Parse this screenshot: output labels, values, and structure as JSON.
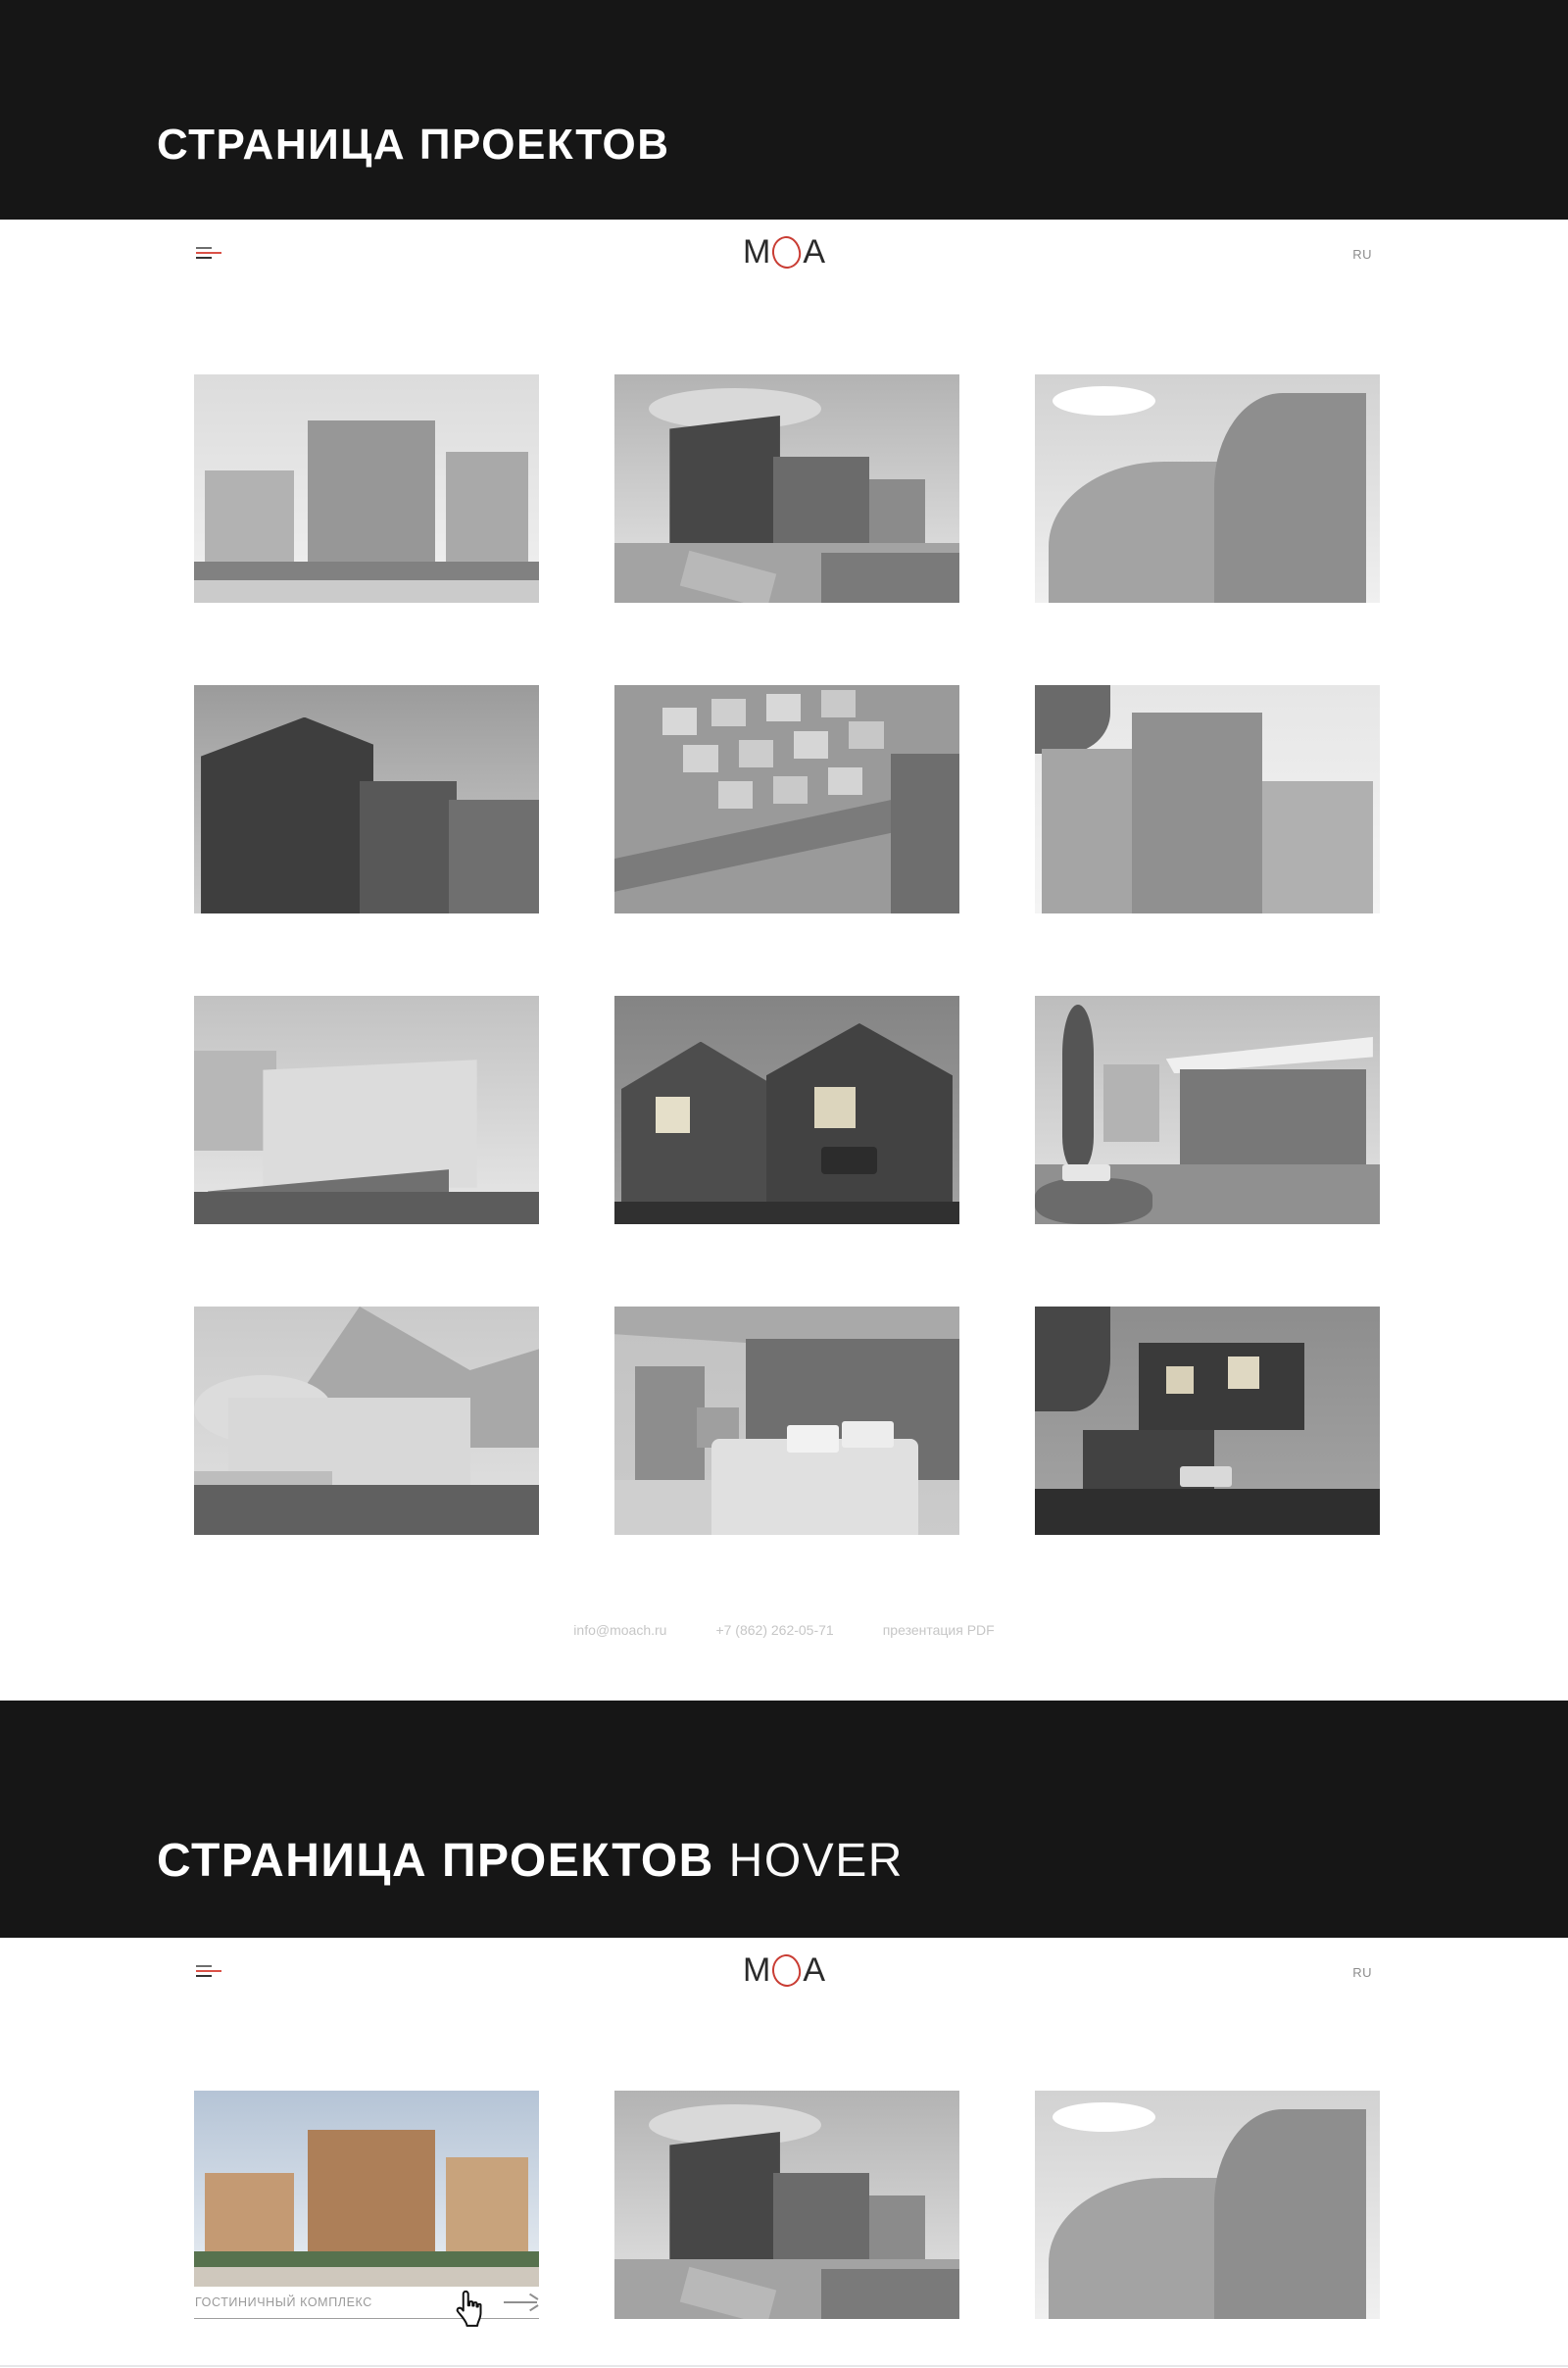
{
  "banners": {
    "projects_page_title": "СТРАНИЦА ПРОЕКТОВ",
    "hover_suffix": "HOVER"
  },
  "header": {
    "logo_text": "MOA",
    "logo_m": "M",
    "logo_a": "A",
    "lang": "RU"
  },
  "footer": {
    "email": "info@moach.ru",
    "phone": "+7 (862) 262-05-71",
    "pdf_link": "презентация PDF"
  },
  "hover_card": {
    "caption": "ГОСТИНИЧНЫЙ КОМПЛЕКС",
    "art": "hotel-complex-color"
  },
  "galleries": {
    "projects": [
      "hotel-complex",
      "corner-building",
      "curved-tower",
      "dark-facade",
      "aerial-townhouses",
      "brick-towers",
      "hillside-apartments",
      "gabled-houses",
      "pavilion",
      "mountain-hotel",
      "bedroom-interior",
      "hillside-villas"
    ],
    "projects_hover_rest": [
      "corner-building",
      "curved-tower"
    ]
  },
  "colors": {
    "banner_bg": "#161616",
    "accent_red": "#c93d34",
    "muted_text": "#8c8c8c",
    "footer_text": "#c6c6c6"
  }
}
